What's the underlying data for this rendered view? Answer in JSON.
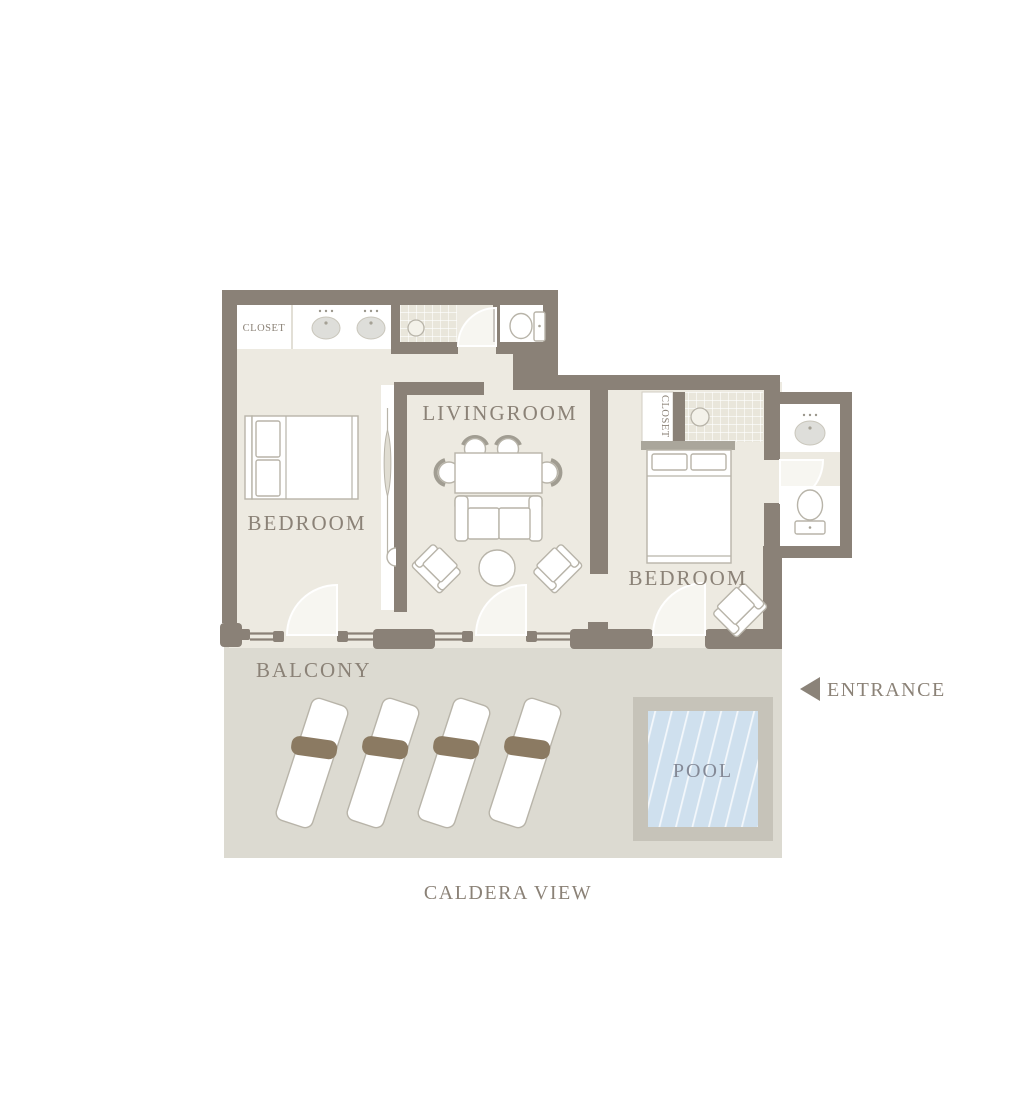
{
  "plan": {
    "labels": {
      "closet_top": "CLOSET",
      "closet_right": "CLOSET",
      "livingroom": "LIVINGROOM",
      "bedroom_left": "BEDROOM",
      "bedroom_right": "BEDROOM",
      "balcony": "BALCONY",
      "pool": "POOL",
      "entrance": "ENTRANCE",
      "caldera_view": "CALDERA VIEW"
    },
    "colors": {
      "wall": "#8a8177",
      "room_floor": "#edeae1",
      "balcony_floor": "#dcdad1",
      "tile": "#e9e6db",
      "pool_frame": "#c6c3b9",
      "pool_water": "#cfe0ee",
      "lounger_cushion": "#8b7a62",
      "furniture_outline": "#b8b4a9",
      "label_text": "#8b8277",
      "pool_text": "#848996"
    }
  }
}
